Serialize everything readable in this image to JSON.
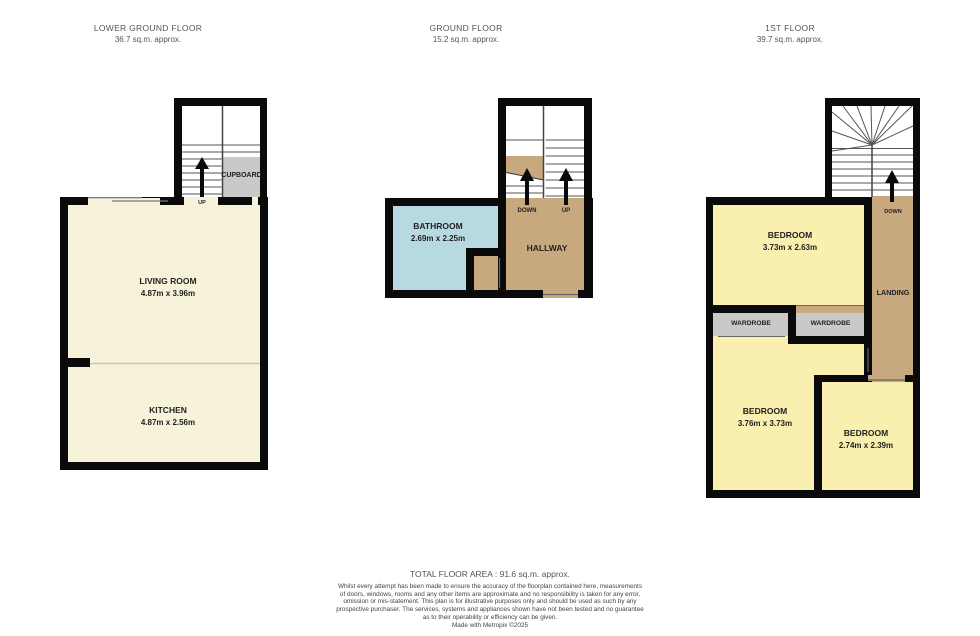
{
  "floors": {
    "lower_ground": {
      "title": "LOWER GROUND FLOOR",
      "area": "36.7 sq.m. approx.",
      "rooms": {
        "living_room": {
          "name": "LIVING ROOM",
          "dims": "4.87m  x 3.96m"
        },
        "kitchen": {
          "name": "KITCHEN",
          "dims": "4.87m  x 2.56m"
        },
        "cupboard": {
          "name": "CUPBOARD"
        }
      },
      "stairs": {
        "up": "UP"
      }
    },
    "ground": {
      "title": "GROUND FLOOR",
      "area": "15.2 sq.m. approx.",
      "rooms": {
        "bathroom": {
          "name": "BATHROOM",
          "dims": "2.69m  x 2.25m"
        },
        "hallway": {
          "name": "HALLWAY"
        }
      },
      "stairs": {
        "down": "DOWN",
        "up": "UP"
      }
    },
    "first": {
      "title": "1ST FLOOR",
      "area": "39.7 sq.m. approx.",
      "rooms": {
        "bedroom_top": {
          "name": "BEDROOM",
          "dims": "3.73m  x 2.63m"
        },
        "bedroom_left": {
          "name": "BEDROOM",
          "dims": "3.76m  x 3.73m"
        },
        "bedroom_right": {
          "name": "BEDROOM",
          "dims": "2.74m  x 2.39m"
        },
        "wardrobe_left": {
          "name": "WARDROBE"
        },
        "wardrobe_right": {
          "name": "WARDROBE"
        },
        "landing": {
          "name": "LANDING"
        }
      },
      "stairs": {
        "down": "DOWN"
      }
    }
  },
  "footer": {
    "total_area": "TOTAL FLOOR AREA : 91.6 sq.m. approx.",
    "disclaimer_lines": [
      "Whilst every attempt has been made to ensure the accuracy of the floorplan contained here, measurements",
      "of doors, windows, rooms and any other items are approximate and no responsibility is taken for any error,",
      "omission or mis-statement. This plan is for illustrative purposes only and should be used as such by any",
      "prospective purchaser. The services, systems and appliances shown have not been tested and no guarantee",
      "as to their operability or efficiency can be given.",
      "Made with Metropix ©2025"
    ]
  },
  "colors": {
    "wall": "#0a0a0a",
    "living_kitchen": "#f7f3db",
    "bedroom": "#f9efae",
    "hall_landing": "#c8a87e",
    "bathroom": "#b7dae2",
    "cupboard_wardrobe": "#c9c9c9"
  }
}
